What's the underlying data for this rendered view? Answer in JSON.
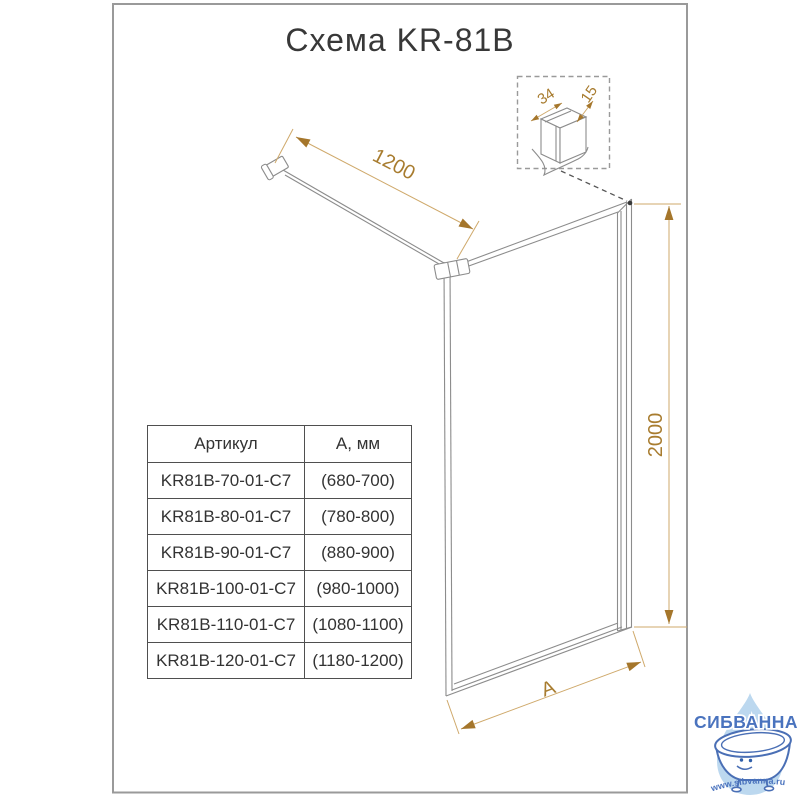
{
  "title": "Схема KR-81B",
  "drawing": {
    "dim_bar_length": "1200",
    "dim_height": "2000",
    "dim_width": "A",
    "detail": {
      "dim_depth": "34",
      "dim_thickness": "15"
    }
  },
  "table": {
    "headers": [
      "Артикул",
      "А, мм"
    ],
    "rows": [
      {
        "article": "KR81B-70-01-C7",
        "size_mm": "(680-700)"
      },
      {
        "article": "KR81B-80-01-C7",
        "size_mm": "(780-800)"
      },
      {
        "article": "KR81B-90-01-C7",
        "size_mm": "(880-900)"
      },
      {
        "article": "KR81B-100-01-C7",
        "size_mm": "(980-1000)"
      },
      {
        "article": "KR81B-110-01-C7",
        "size_mm": "(1080-1100)"
      },
      {
        "article": "KR81B-120-01-C7",
        "size_mm": "(1180-1200)"
      }
    ]
  },
  "watermark": {
    "brand": "СИБВАННА",
    "url": "www.sibvanna.ru"
  },
  "colors": {
    "dimension_gold": "#a87c2f",
    "line_gray": "#8c8c8c",
    "frame_gray": "#9a9a9a",
    "logo_blue": "#4a73be",
    "logo_drop": "#bcd8ef"
  }
}
